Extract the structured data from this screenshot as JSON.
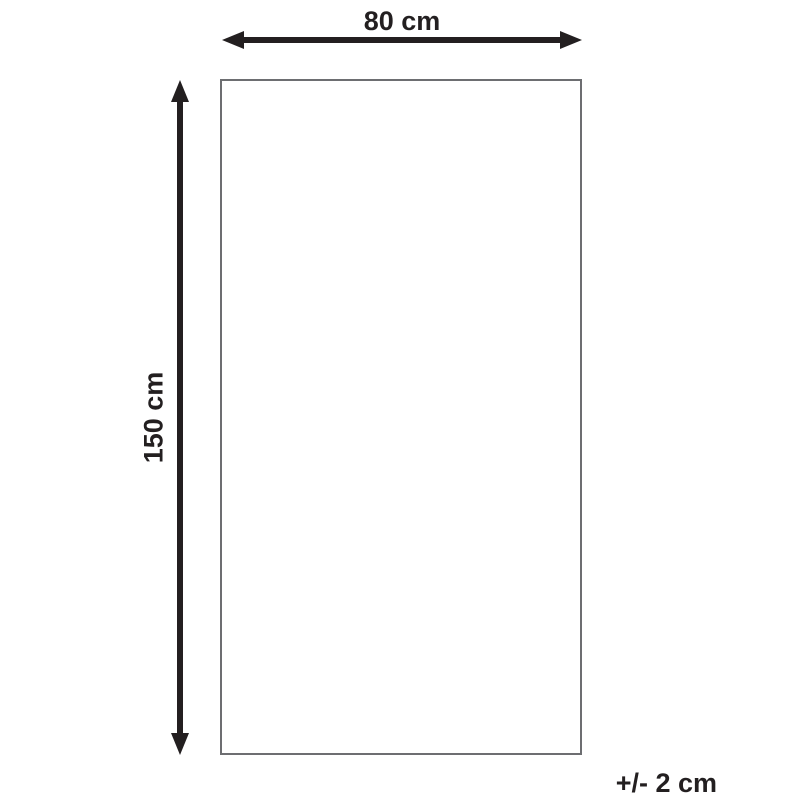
{
  "diagram": {
    "type": "product-dimension-diagram",
    "width_label": "80 cm",
    "height_label": "150 cm",
    "tolerance_label": "+/- 2 cm",
    "colors": {
      "arrow": "#231f20",
      "text": "#231f20",
      "rect_border": "#6d6e71",
      "background": "#ffffff"
    }
  }
}
